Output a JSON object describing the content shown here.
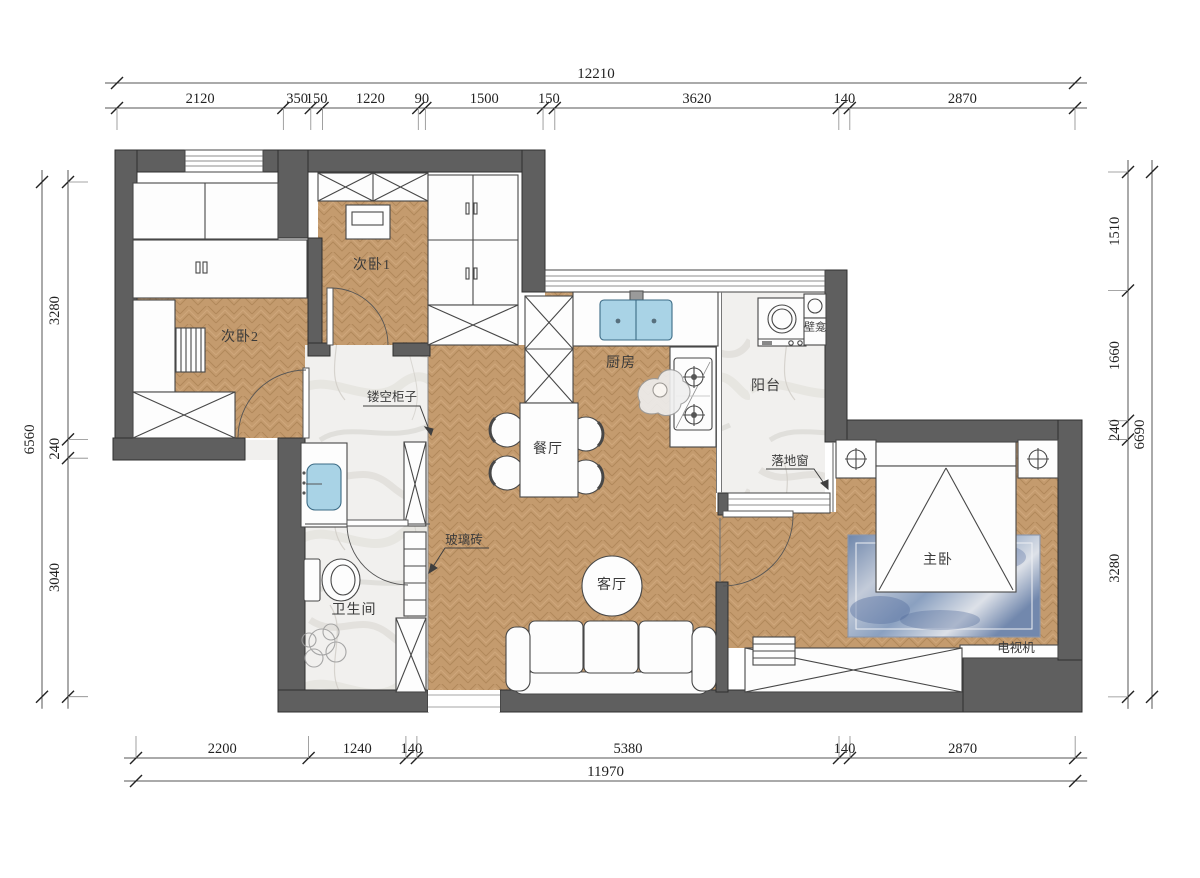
{
  "rooms": {
    "bedroom1": "次卧1",
    "bedroom2": "次卧2",
    "kitchen": "厨房",
    "balcony": "阳台",
    "dining": "餐厅",
    "living": "客厅",
    "master": "主卧",
    "bathroom": "卫生间"
  },
  "annotations": {
    "hollow_cabinet": "镂空柜子",
    "glass_brick": "玻璃砖",
    "french_window": "落地窗",
    "tv": "电视机",
    "niche": "壁龛"
  },
  "dimensions": {
    "top": {
      "total": "12210",
      "segments": [
        2120,
        350,
        150,
        1220,
        90,
        1500,
        150,
        3620,
        140,
        2870
      ]
    },
    "bottom": {
      "total": "11970",
      "segments": [
        2200,
        1240,
        140,
        5380,
        140,
        2870
      ]
    },
    "left": {
      "total": "6560",
      "segments": [
        3280,
        240,
        3040
      ]
    },
    "right": {
      "total": "6690",
      "segments": [
        1510,
        1660,
        240,
        3280
      ]
    }
  },
  "colors": {
    "wall": "#5f5f5f",
    "wood_floor": "#c49b6e",
    "marble_floor": "#f1f0ee",
    "sink_blue": "#a9d3e6",
    "rug_blue": "#8095b6",
    "line": "#3f3f3f"
  }
}
